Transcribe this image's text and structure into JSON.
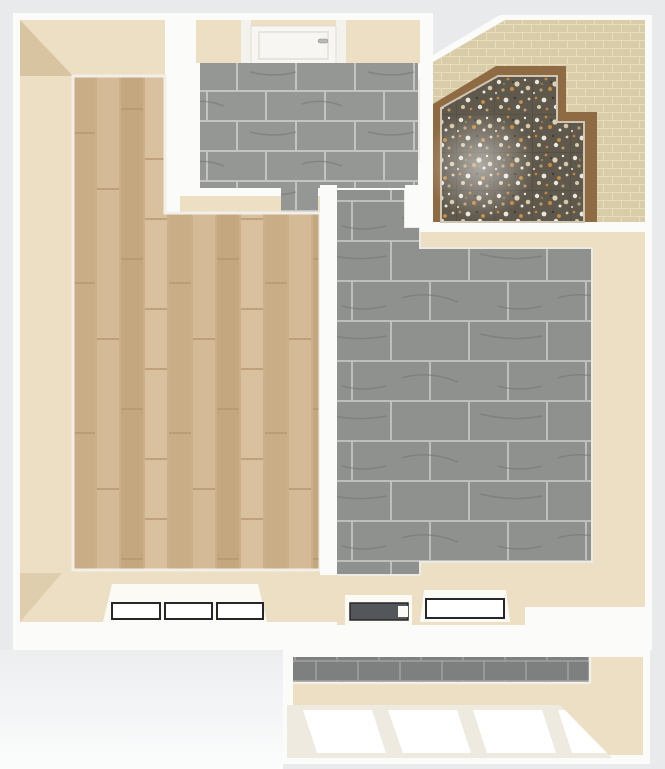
{
  "scene": {
    "description": "3D top-down architectural render of a one-bedroom apartment floor plan with balcony; photoreal textures, no visible text",
    "view": "top-down perspective",
    "canvas": {
      "width_px": 665,
      "height_px": 769
    }
  },
  "palette": {
    "bg": "#e8eaec",
    "bg-light": "#f7f8f9",
    "wall-white": "#fbfbfa",
    "beige-face": "#ecdfc4",
    "beige-dark": "#d5c09a",
    "recess-white": "#fbfaf4",
    "pane-white": "#ffffff",
    "line-dark": "#26272a",
    "glass-dark": "#54575a",
    "brown-border": "#8f6b44",
    "door-white": "#f7f6f2",
    "frame-cream": "#efeadf",
    "wood-base": "#cbb08a",
    "wood-1": "#d4ba97",
    "wood-2": "#c5a77f",
    "wood-3": "#d9c1a0",
    "wood-4": "#c9ad86",
    "tile-gray": "#8f918f",
    "tile-grout": "#bdbfbd",
    "tile-vein": "#6e716f",
    "tile-bath": "#959795",
    "tile-balcony": "#7d807e",
    "wall-tile": "#d9cda9",
    "wall-tile-grout": "#e8ddbd",
    "terrazzo-base": "#5f584c",
    "speckle-orange": "#c4873c",
    "speckle-cream": "#d8c9a5",
    "speckle-white": "#ece7db",
    "speckle-tan": "#b99f6e"
  },
  "rooms": [
    {
      "id": "room-left",
      "label": "large room with light wood plank flooring (bedroom/living with hallway)",
      "floor": "wood-planks"
    },
    {
      "id": "room-top-center",
      "label": "small room with gray marble tiles and white door at top wall (bathroom)",
      "floor": "gray-marble-tile"
    },
    {
      "id": "room-top-right",
      "label": "room with dark terrazzo speckled floor, brown border and beige tiled walls",
      "floor": "dark-terrazzo"
    },
    {
      "id": "room-right",
      "label": "large room with gray marble tile flooring (kitchen/living)",
      "floor": "gray-marble-tile"
    },
    {
      "id": "balcony",
      "label": "balcony with gray tile strip and glazed front",
      "floor": "gray-tile"
    }
  ],
  "openings": {
    "bathroom_door": {
      "type": "white panel door with small handle",
      "location": "top wall of top-center room"
    },
    "side_door": {
      "type": "white door leaf",
      "location": "right wall of top-center room"
    },
    "interior_doorway": {
      "type": "open doorway",
      "location": "between hallway and top-center room"
    },
    "bedroom_window": {
      "panes": 3,
      "frame": "dark outline, white glass",
      "location": "bottom wall left"
    },
    "balcony_door": {
      "panes": 1,
      "glass": "dark gray",
      "location": "bottom wall center-left of kitchen"
    },
    "kitchen_window": {
      "panes": 1,
      "glass": "white",
      "location": "bottom wall center of kitchen"
    },
    "balcony_glazing": {
      "panes": 4,
      "slant": "perspective-slanted white mullions",
      "location": "balcony front"
    }
  }
}
